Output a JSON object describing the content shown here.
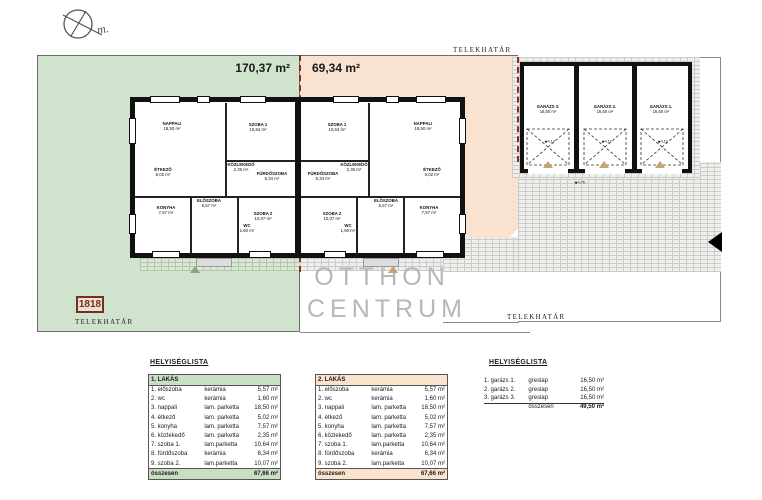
{
  "site": {
    "north_label": "m.",
    "boundary_label": "TELEKHATÁR",
    "parcel_left_area": "170,37 m²",
    "parcel_right_area": "69,34 m²",
    "parcel_number": "1818",
    "colors": {
      "parcel_green": "#d0e3cc",
      "parcel_peach": "#f9e3d0",
      "boundary_red": "#8b2e1f",
      "table_green": "#c8dfc4",
      "table_peach": "#fbe3cd",
      "watermark_gray": "#b7b7b7"
    }
  },
  "floorplan": {
    "rooms": [
      {
        "name": "NAPPALI",
        "area": "18,50 m²"
      },
      {
        "name": "SZOBA 1",
        "area": "10,64 m²"
      },
      {
        "name": "ÉTKEZŐ",
        "area": "5,02 m²"
      },
      {
        "name": "KÖZLEKEDŐ",
        "area": "2,35 m²"
      },
      {
        "name": "FÜRDŐSZOBA",
        "area": "6,34 m²"
      },
      {
        "name": "KONYHA",
        "area": "7,57 m²"
      },
      {
        "name": "ELŐSZOBA",
        "area": "5,57 m²"
      },
      {
        "name": "WC",
        "area": "1,60 m²"
      },
      {
        "name": "SZOBA 2",
        "area": "10,07 m²"
      }
    ]
  },
  "garage": {
    "bays": [
      {
        "label": "GARÁZS 3.",
        "area": "16,50 m²",
        "door_dim": "4,12"
      },
      {
        "label": "GARÁZS 2.",
        "area": "16,50 m²",
        "door_dim": "4,12"
      },
      {
        "label": "GARÁZS 1.",
        "area": "16,50 m²",
        "door_dim": "4,12"
      }
    ],
    "front_dim": "4,76"
  },
  "watermark": {
    "line1": "OTTHON",
    "line2": "CENTRUM"
  },
  "tables": {
    "list_title_left": "HELYISÉGLISTA",
    "list_title_right": "HELYISÉGLISTA",
    "apartment1": {
      "header": "1. LAKÁS",
      "header_color": "#c8dfc4",
      "rows": [
        [
          "1. előszoba",
          "kerámia",
          "5,57 m²"
        ],
        [
          "2. wc",
          "kerámia",
          "1,60 m²"
        ],
        [
          "3. nappali",
          "lam. parketta",
          "18,50 m²"
        ],
        [
          "4. étkező",
          "lam. parketta",
          "5,02 m²"
        ],
        [
          "5. konyha",
          "lam. parketta",
          "7,57 m²"
        ],
        [
          "6. közlekedő",
          "lam. parketta",
          "2,35 m²"
        ],
        [
          "7. szoba 1.",
          "lam.parketta",
          "10,64 m²"
        ],
        [
          "8. fürdőszoba",
          "kerámia",
          "6,34 m²"
        ],
        [
          "9. szoba 2.",
          "lam.parketta",
          "10,07 m²"
        ]
      ],
      "total_label": "összesen",
      "total": "67,66 m²"
    },
    "apartment2": {
      "header": "2. LAKÁS",
      "header_color": "#fbe3cd",
      "rows": [
        [
          "1. előszoba",
          "kerámia",
          "5,57 m²"
        ],
        [
          "2. wc",
          "kerámia",
          "1,60 m²"
        ],
        [
          "3. nappali",
          "lam. parketta",
          "18,50 m²"
        ],
        [
          "4. étkező",
          "lam. parketta",
          "5,02 m²"
        ],
        [
          "5. konyha",
          "lam. parketta",
          "7,57 m²"
        ],
        [
          "6. közlekedő",
          "lam. parketta",
          "2,35 m²"
        ],
        [
          "7. szoba 1.",
          "lam.parketta",
          "10,64 m²"
        ],
        [
          "8. fürdőszoba",
          "kerámia",
          "6,34 m²"
        ],
        [
          "9. szoba 2.",
          "lam.parketta",
          "10,07 m²"
        ]
      ],
      "total_label": "összesen",
      "total": "67,66 m²"
    },
    "garage_list": {
      "rows": [
        [
          "1. garázs 1.",
          "greslap",
          "16,50 m²"
        ],
        [
          "2. garázs 2.",
          "greslap",
          "16,50 m²"
        ],
        [
          "3. garázs 3.",
          "greslap",
          "16,50 m²"
        ]
      ],
      "total_label": "összesen",
      "total": "49,50 m²"
    }
  }
}
